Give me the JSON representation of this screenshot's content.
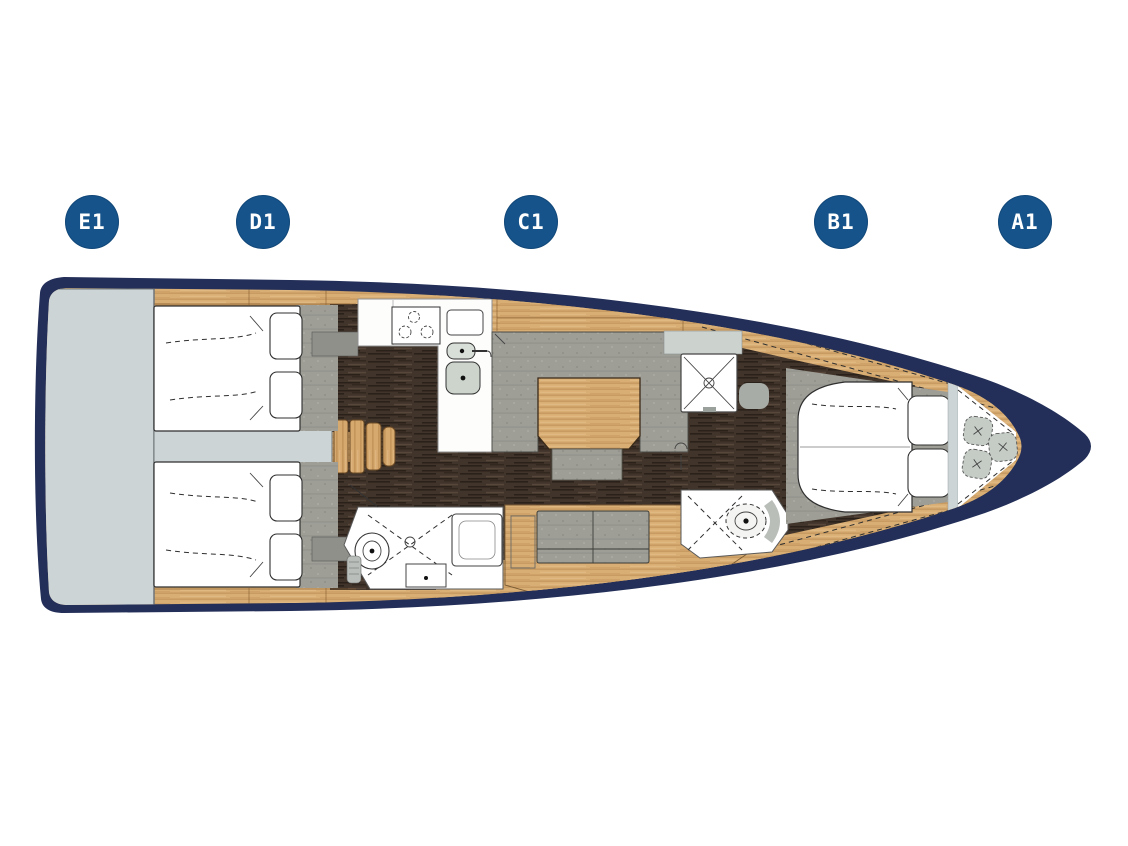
{
  "diagram": {
    "type": "yacht-floorplan",
    "orientation": "bow-right"
  },
  "cabin_badges": [
    {
      "label": "E1"
    },
    {
      "label": "D1"
    },
    {
      "label": "C1"
    },
    {
      "label": "B1"
    },
    {
      "label": "A1"
    }
  ],
  "colors": {
    "background": "#ffffff",
    "hull": "#232f58",
    "deck_wood": "#d9ae74",
    "floor_dark": "#41342a",
    "upholstery": "#9e9e97",
    "platform_gray": "#cdd4d6",
    "room_white": "#ffffff",
    "badge_blue": "#15538a",
    "badge_text": "#ffffff",
    "outline": "#333333"
  }
}
